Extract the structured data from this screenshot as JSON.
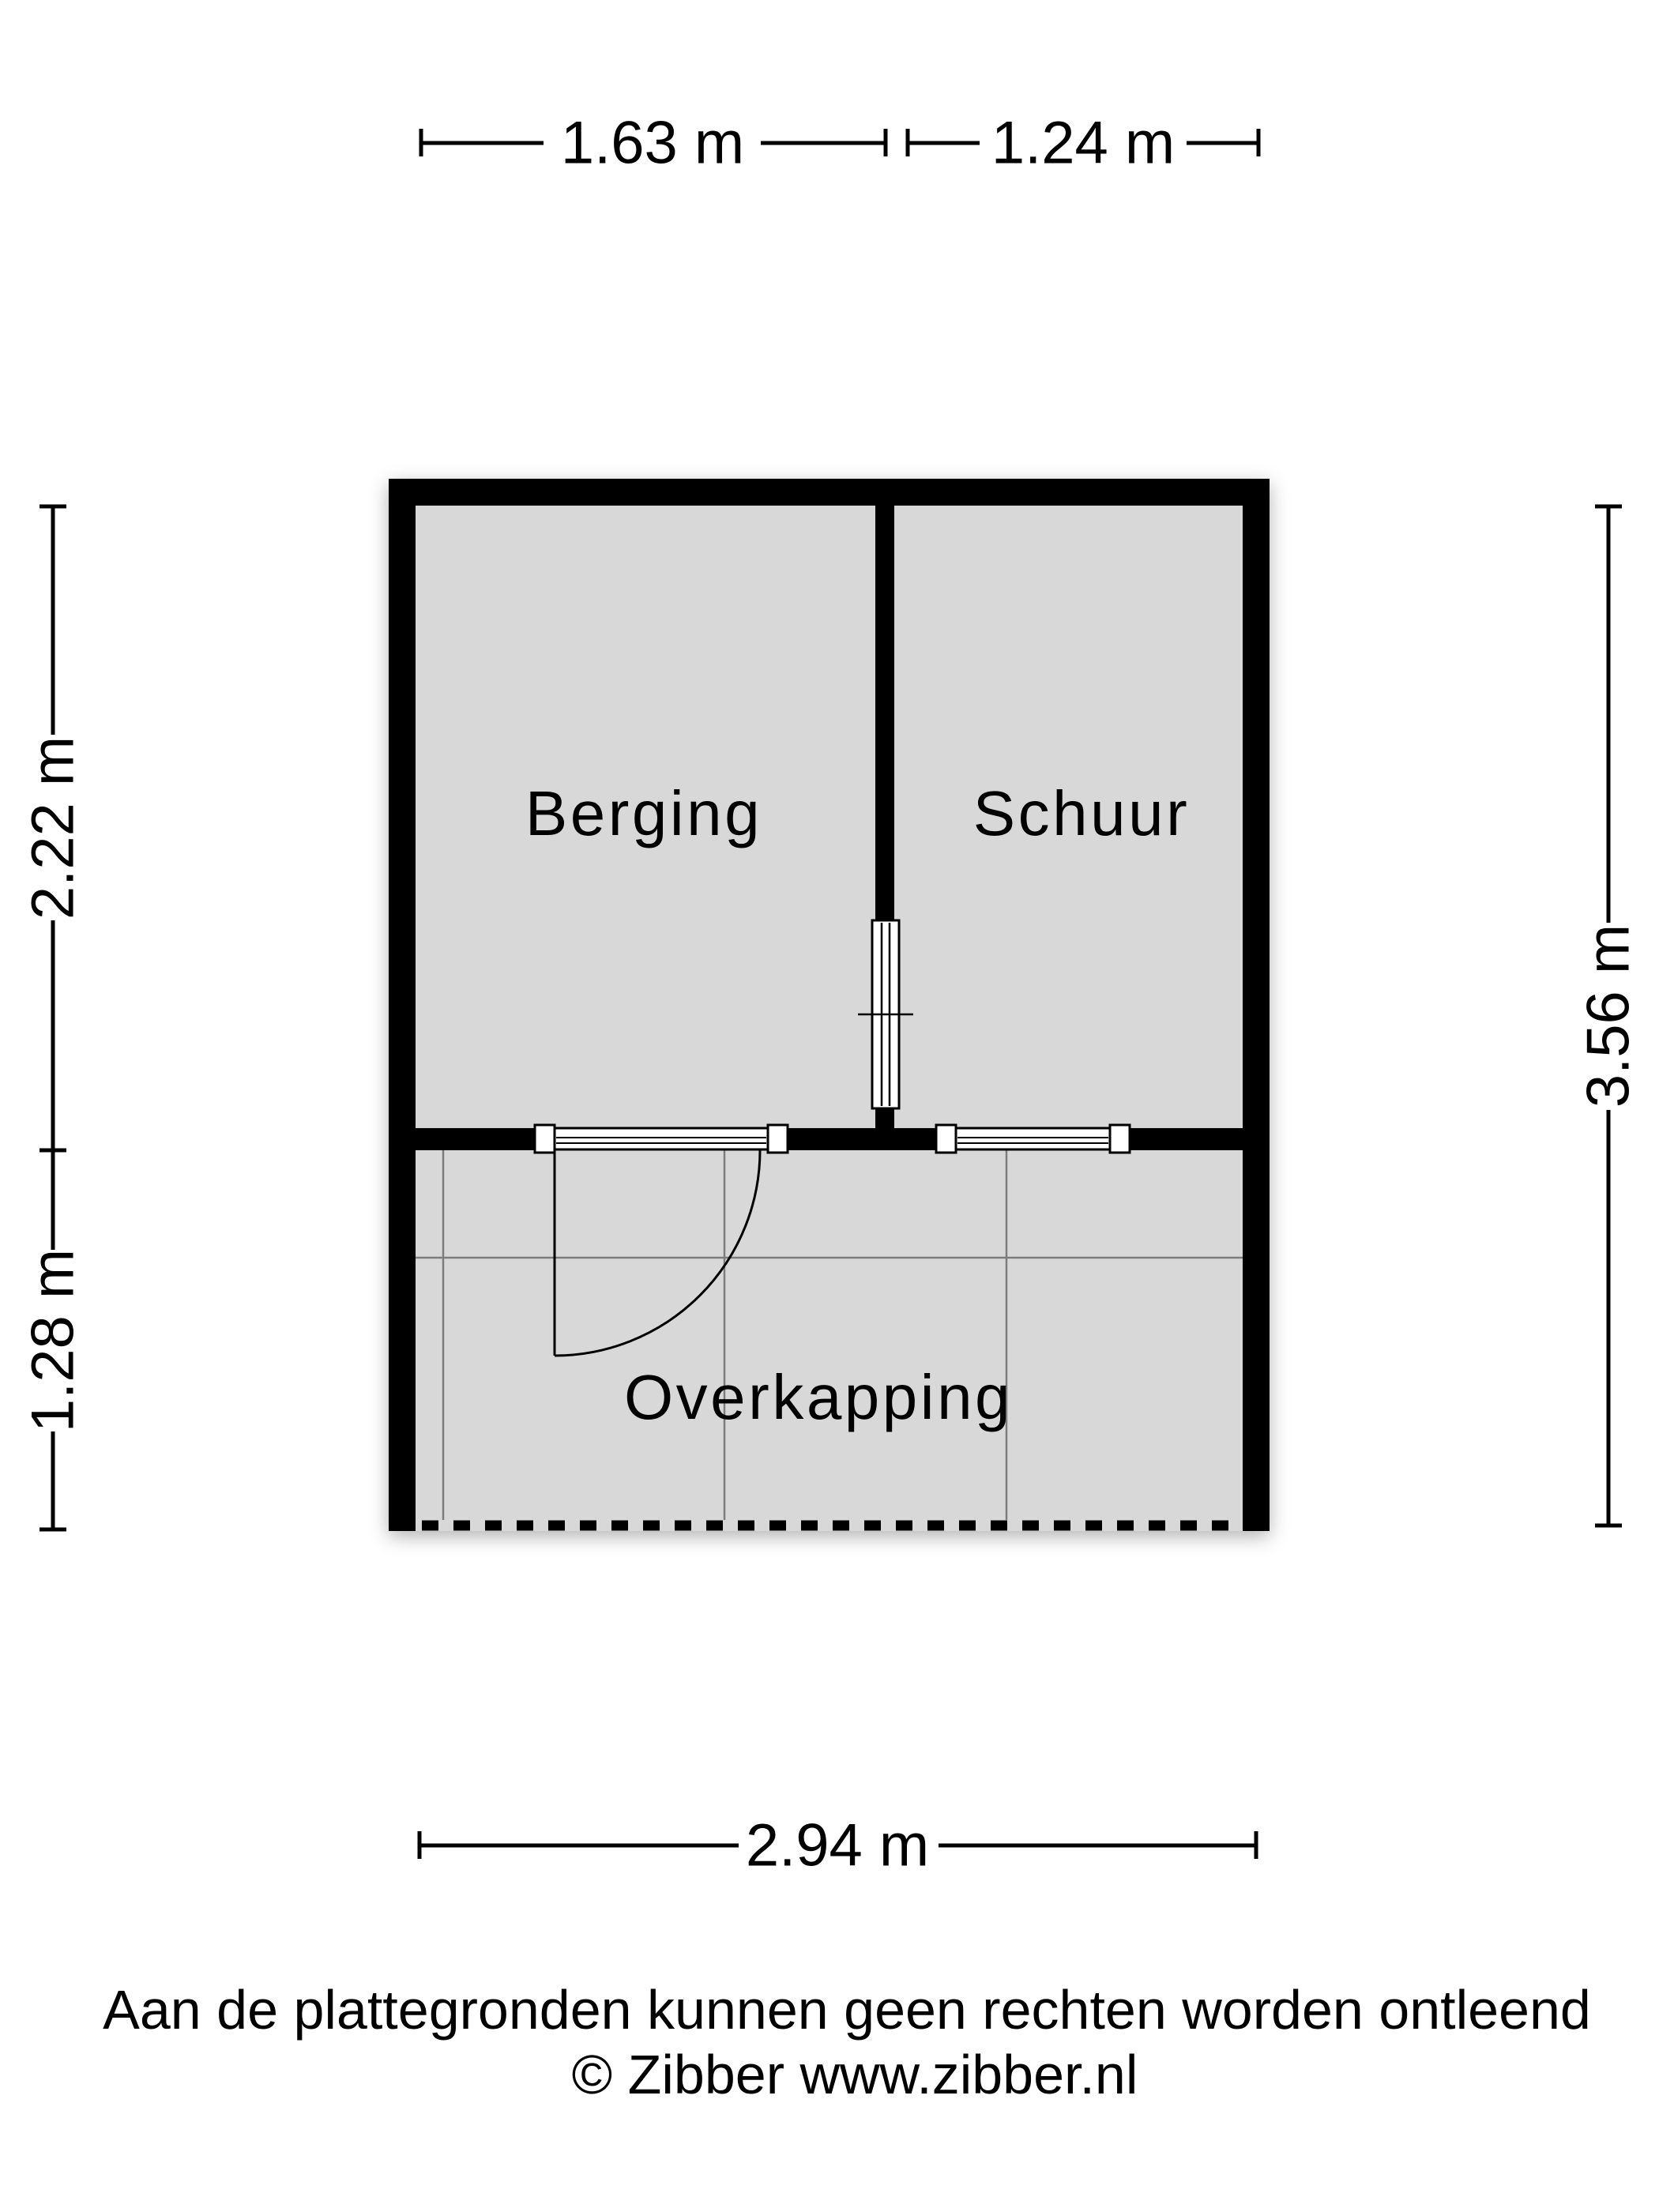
{
  "floor_plan": {
    "rooms": [
      {
        "name": "Berging"
      },
      {
        "name": "Schuur"
      },
      {
        "name": "Overkapping"
      }
    ],
    "dimensions": {
      "top": [
        "1.63 m",
        "1.24 m"
      ],
      "left": [
        "2.22 m",
        "1.28 m"
      ],
      "right": [
        "3.56 m"
      ],
      "bottom": [
        "2.94 m"
      ]
    },
    "colors": {
      "wall": "#000000",
      "floor": "#d8d8d8",
      "grid": "#7d7d7d"
    }
  },
  "footer": {
    "disclaimer": "Aan de plattegronden kunnen geen rechten worden ontleend",
    "copyright": "© Zibber www.zibber.nl"
  }
}
